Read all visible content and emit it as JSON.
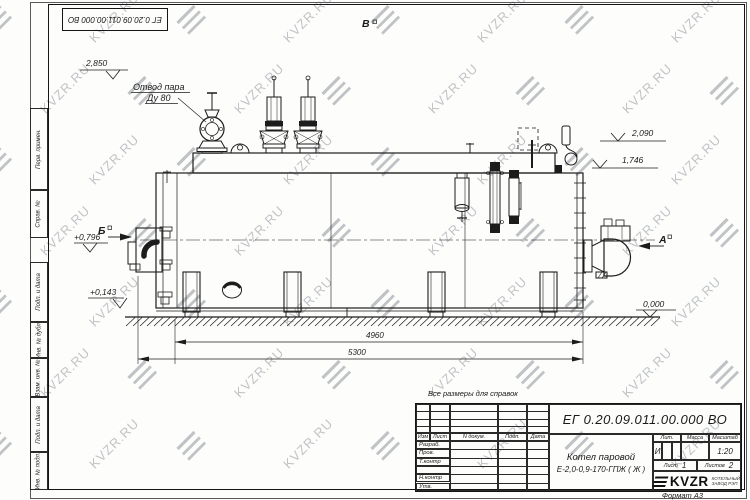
{
  "watermark": {
    "text": "KVZR.RU"
  },
  "stamp_top": {
    "doc_number": "ЕГ 0.20.09.011.00.000  ВО"
  },
  "side_column": {
    "labels": [
      "Перв. примен.",
      "Справ. №",
      "Подп. и дата",
      "Инв. № дубл.",
      "Взам. инв. №",
      "Подп. и дата",
      "Инв. № подл."
    ]
  },
  "drawing": {
    "callout_line1": "Отвод пара",
    "callout_line2": "Ду 80",
    "view_labels": {
      "a": "А",
      "b": "Б",
      "v": "В"
    },
    "elevations": {
      "top_left": "2,850",
      "right_upper": "2,090",
      "right_lower": "1,746",
      "left_mid": "+0,796",
      "left_low": "+0,143",
      "ground": "0,000"
    },
    "dimensions": {
      "inner": "4960",
      "overall": "5300"
    }
  },
  "note": "Все размеры для справок",
  "title_block": {
    "doc_number": "ЕГ 0.20.09.011.00.000  ВО",
    "product_line1": "Котел паровой",
    "product_line2": "Е-2,0-0,9-170-ГПЖ ( Ж )",
    "header_cols": [
      "Изм",
      "Лист",
      "N докум.",
      "Подп.",
      "Дата"
    ],
    "rows": [
      "Разраб.",
      "Пров.",
      "Т.контр",
      "",
      "Н.контр",
      "Утв."
    ],
    "lit_header": "Лит.",
    "mass_header": "Масса",
    "scale_header": "Масштаб",
    "lit_value": "И",
    "scale_value": "1:20",
    "sheet_label": "Лист",
    "sheet_value": "1",
    "sheets_label": "Листов",
    "sheets_value": "2",
    "company": "KVZR",
    "company_sub1": "КОТЕЛЬНЫЙ",
    "company_sub2": "ЗАВОД РЭП",
    "format_label": "Формат  А3"
  }
}
